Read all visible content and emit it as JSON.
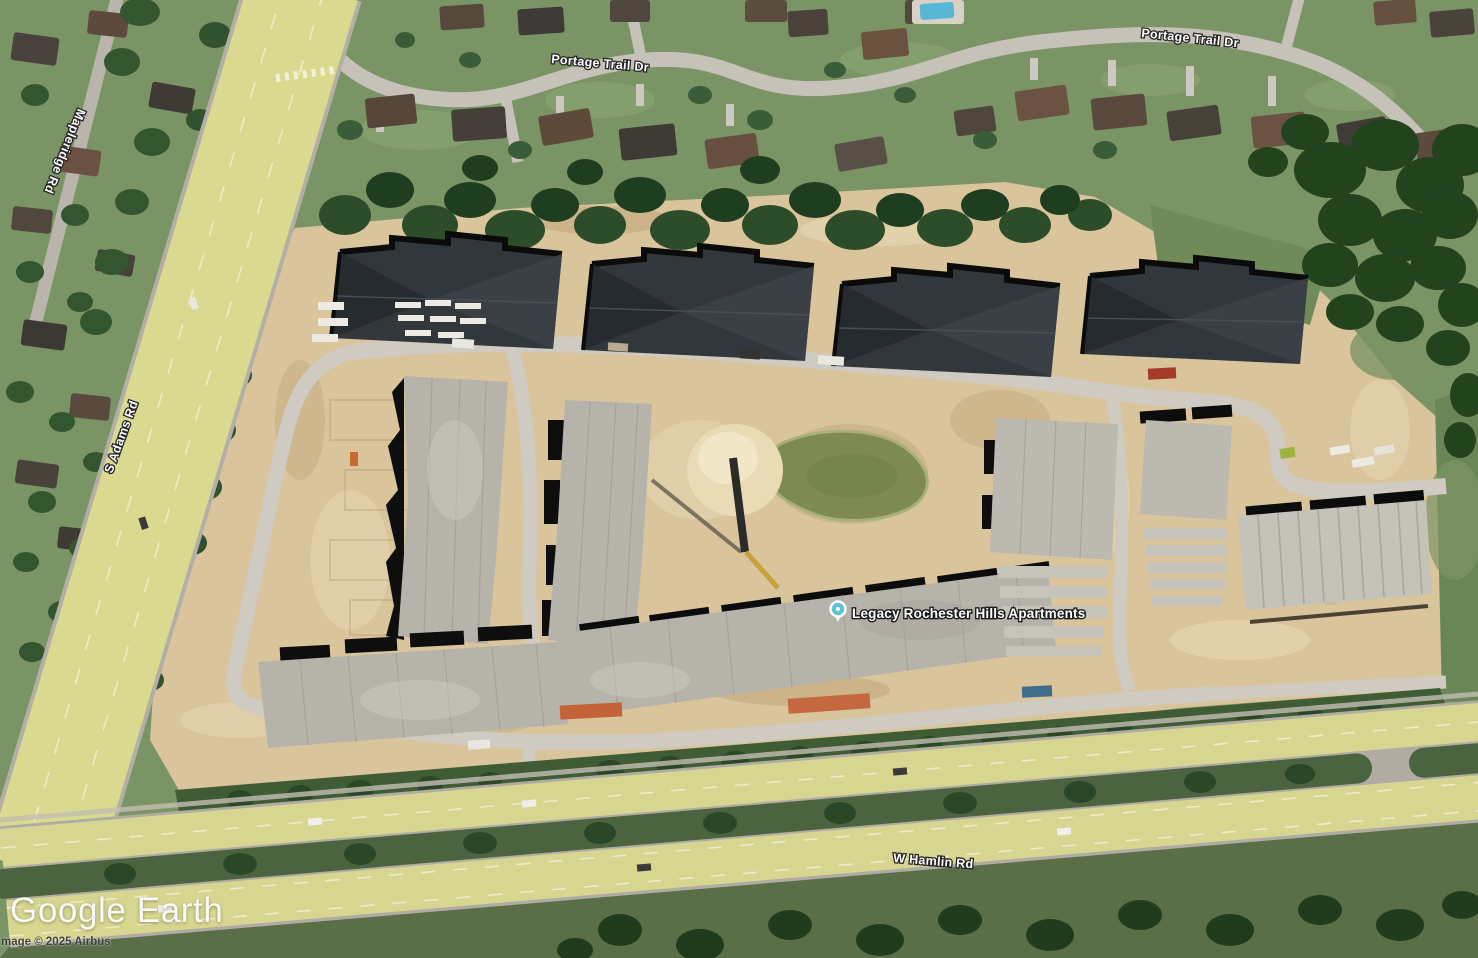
{
  "app": {
    "logo_text": "Google Earth",
    "attribution": "mage © 2025 Airbus"
  },
  "map": {
    "type": "satellite-imagery",
    "place_marker": {
      "label": "Legacy Rochester Hills Apartments"
    },
    "road_labels": [
      {
        "id": "portage-trail-dr-west",
        "text": "Portage Trail Dr"
      },
      {
        "id": "portage-trail-dr-east",
        "text": "Portage Trail Dr"
      },
      {
        "id": "mapleridge-rd",
        "text": "Mapleridge Rd"
      },
      {
        "id": "s-adams-rd",
        "text": "S Adams Rd"
      },
      {
        "id": "w-hamlin-rd",
        "text": "W Hamlin Rd"
      }
    ],
    "colors": {
      "road_highlight": "#e4e58a",
      "pond": "#7e8a52",
      "dirt": "#d9c49c",
      "concrete_slab": "#b6b3aa",
      "dark_roof": "#32373c",
      "marker": "#5ec3d6"
    }
  }
}
